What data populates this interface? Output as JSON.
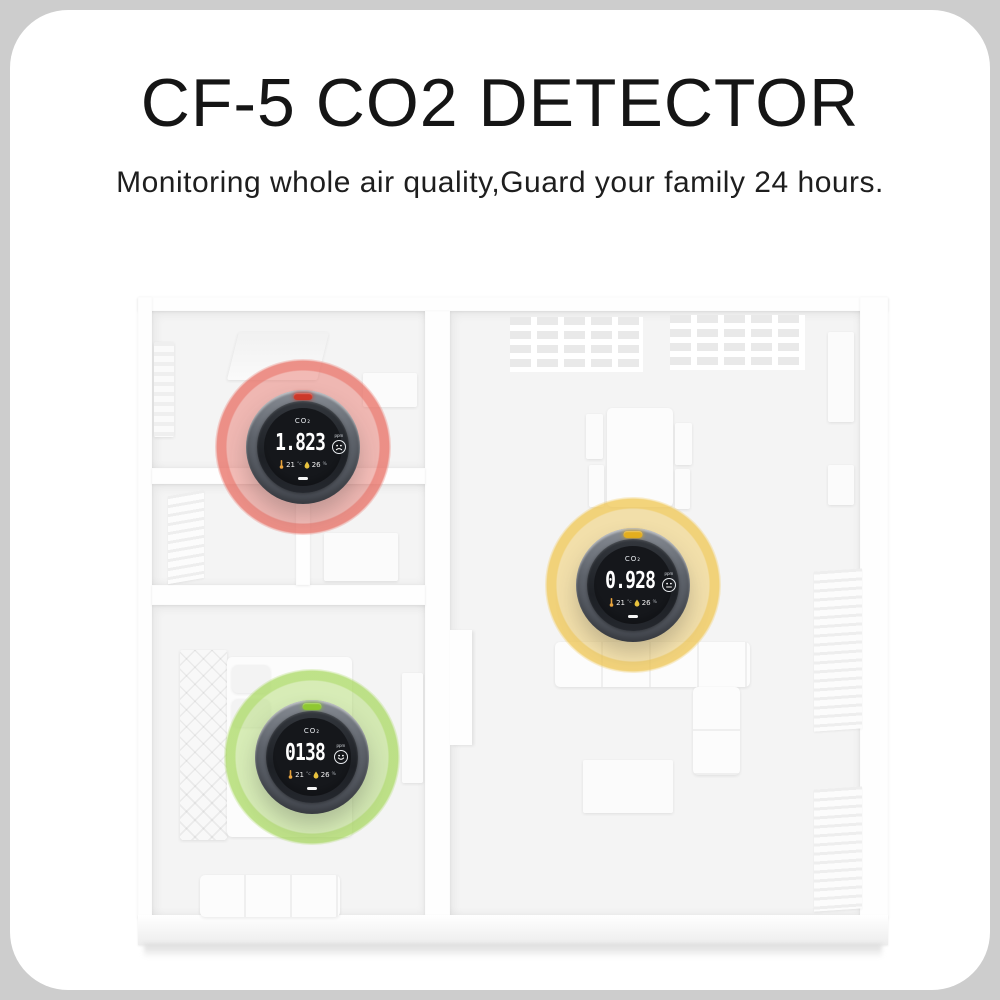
{
  "colors": {
    "page_background": "#cdcdcd",
    "card_background": "#ffffff",
    "title_color": "#151515"
  },
  "header": {
    "title": "CF-5 CO2 DETECTOR",
    "subtitle": "Monitoring whole air quality,Guard your family 24 hours."
  },
  "detector_common": {
    "gas_label": "CO₂",
    "unit_label": "ppm"
  },
  "detectors": [
    {
      "reading": "1.823",
      "face": "sad",
      "temp_value": "21",
      "temp_unit": "°c",
      "humidity_value": "26",
      "humidity_unit": "%",
      "glow_rgb": "233,109,98",
      "led_color": "#cc392a"
    },
    {
      "reading": "0.928",
      "face": "neutral",
      "temp_value": "21",
      "temp_unit": "°c",
      "humidity_value": "26",
      "humidity_unit": "%",
      "glow_rgb": "240,198,80",
      "led_color": "#e3ae1f"
    },
    {
      "reading": "0138",
      "face": "happy",
      "temp_value": "21",
      "temp_unit": "°c",
      "humidity_value": "26",
      "humidity_unit": "%",
      "glow_rgb": "170,217,98",
      "led_color": "#8fc832"
    }
  ]
}
